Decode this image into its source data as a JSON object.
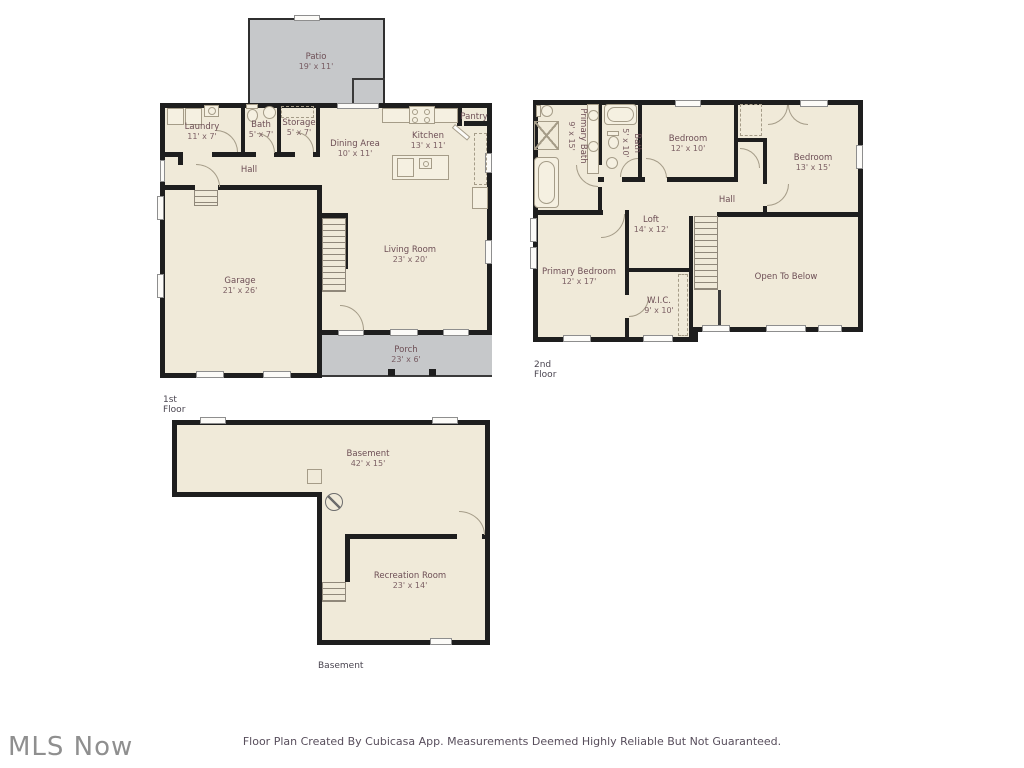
{
  "watermark": "MLS Now",
  "footer": "Floor Plan Created By Cubicasa App. Measurements Deemed Highly Reliable But Not Guaranteed.",
  "colors": {
    "floor_fill": "#f0ead9",
    "outdoor_fill": "#c6c8ca",
    "wall": "#1e1e1e",
    "room_label": "#6d4e55",
    "fixture_line": "#a59c88",
    "watermark_gray": "#8f8f8f"
  },
  "floors": [
    {
      "caption": "1st Floor",
      "rooms": [
        {
          "name": "Patio",
          "dims": "19' x 11'"
        },
        {
          "name": "Laundry",
          "dims": "11' x 7'"
        },
        {
          "name": "Bath",
          "dims": "5' x 7'"
        },
        {
          "name": "Storage",
          "dims": "5' x 7'"
        },
        {
          "name": "Hall"
        },
        {
          "name": "Dining Area",
          "dims": "10' x 11'"
        },
        {
          "name": "Kitchen",
          "dims": "13' x 11'"
        },
        {
          "name": "Pantry"
        },
        {
          "name": "Garage",
          "dims": "21' x 26'"
        },
        {
          "name": "Living Room",
          "dims": "23' x 20'"
        },
        {
          "name": "Porch",
          "dims": "23' x 6'"
        }
      ]
    },
    {
      "caption": "2nd Floor",
      "rooms": [
        {
          "name": "Primary Bath",
          "dims": "9' x 15'"
        },
        {
          "name": "Bath",
          "dims": "5' x 10'"
        },
        {
          "name": "Bedroom",
          "dims": "12' x 10'"
        },
        {
          "name": "Bedroom",
          "dims": "13' x 15'"
        },
        {
          "name": "Hall"
        },
        {
          "name": "Loft",
          "dims": "14' x 12'"
        },
        {
          "name": "Primary Bedroom",
          "dims": "12' x 17'"
        },
        {
          "name": "W.I.C.",
          "dims": "9' x 10'"
        },
        {
          "name": "Open To Below"
        }
      ]
    },
    {
      "caption": "Basement",
      "rooms": [
        {
          "name": "Basement",
          "dims": "42' x 15'"
        },
        {
          "name": "Recreation Room",
          "dims": "23' x 14'"
        }
      ]
    }
  ]
}
